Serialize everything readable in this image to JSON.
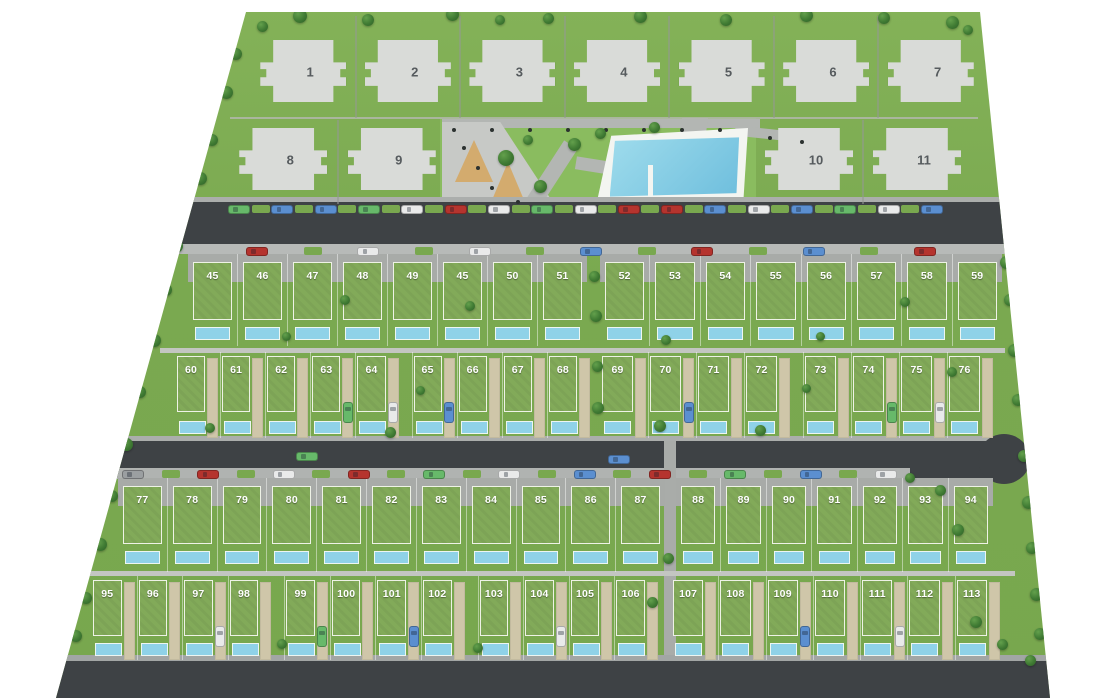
{
  "title": "residential development masterplan",
  "colors": {
    "site_green": "#7aa950",
    "lawn_green": "#8abc5f",
    "garden_green": "#82aa59",
    "tree_green": "#3f7a33",
    "road_dark": "#3e4245",
    "sidewalk_gray": "#b7bab8",
    "path_gray": "#b3b6b3",
    "driveway_tan": "#cfc6a9",
    "pool_blue": "#8fd2e8",
    "building_gray": "#d9dbd8",
    "sand_tan": "#d3ab6e",
    "car_green": "#67b96a",
    "car_blue": "#5b8fd0",
    "car_white": "#e9eaea",
    "car_red": "#b5342e",
    "car_gray": "#9b9fa1"
  },
  "apartments": {
    "row1": [
      "1",
      "2",
      "3",
      "4",
      "5",
      "6",
      "7"
    ],
    "row2_left": [
      "8",
      "9"
    ],
    "row2_right": [
      "10",
      "11"
    ]
  },
  "plots": {
    "row_a_left": [
      "45",
      "46",
      "47",
      "48",
      "49",
      "45",
      "50",
      "51"
    ],
    "row_a_right": [
      "52",
      "53",
      "54",
      "55",
      "56",
      "57",
      "58",
      "59"
    ],
    "row_b_left": [
      "60",
      "61",
      "62",
      "63",
      "64",
      "65",
      "66",
      "67",
      "68"
    ],
    "row_b_right": [
      "69",
      "70",
      "71",
      "72",
      "73",
      "74",
      "75",
      "76"
    ],
    "row_c_left": [
      "77",
      "78",
      "79",
      "80",
      "81",
      "82",
      "83",
      "84",
      "85",
      "86",
      "87"
    ],
    "row_c_right": [
      "88",
      "89",
      "90",
      "91",
      "92",
      "93",
      "94"
    ],
    "row_d_left": [
      "95",
      "96",
      "97",
      "98",
      "99",
      "100",
      "101",
      "102",
      "103",
      "104",
      "105",
      "106"
    ],
    "row_d_right": [
      "107",
      "108",
      "109",
      "110",
      "111",
      "112",
      "113"
    ]
  },
  "driveway_cars": {
    "63": "green",
    "64": "white",
    "65": "blue",
    "70": "blue",
    "74": "green",
    "75": "white",
    "97": "white",
    "99": "green",
    "101": "blue",
    "104": "white",
    "109": "blue",
    "111": "white"
  },
  "road_cars": {
    "top_north": [
      "green",
      "blue",
      "blue",
      "green",
      "white",
      "red",
      "white",
      "green",
      "white",
      "red",
      "red",
      "blue",
      "white",
      "blue",
      "green",
      "white",
      "blue"
    ],
    "top_south": [
      "red",
      "white",
      "white",
      "blue",
      "red",
      "blue",
      "red"
    ],
    "middle_moving": [
      "green",
      "blue"
    ],
    "middle_south": [
      "gray",
      "red",
      "white",
      "red",
      "green",
      "white",
      "blue",
      "red",
      "green",
      "blue",
      "white"
    ]
  }
}
